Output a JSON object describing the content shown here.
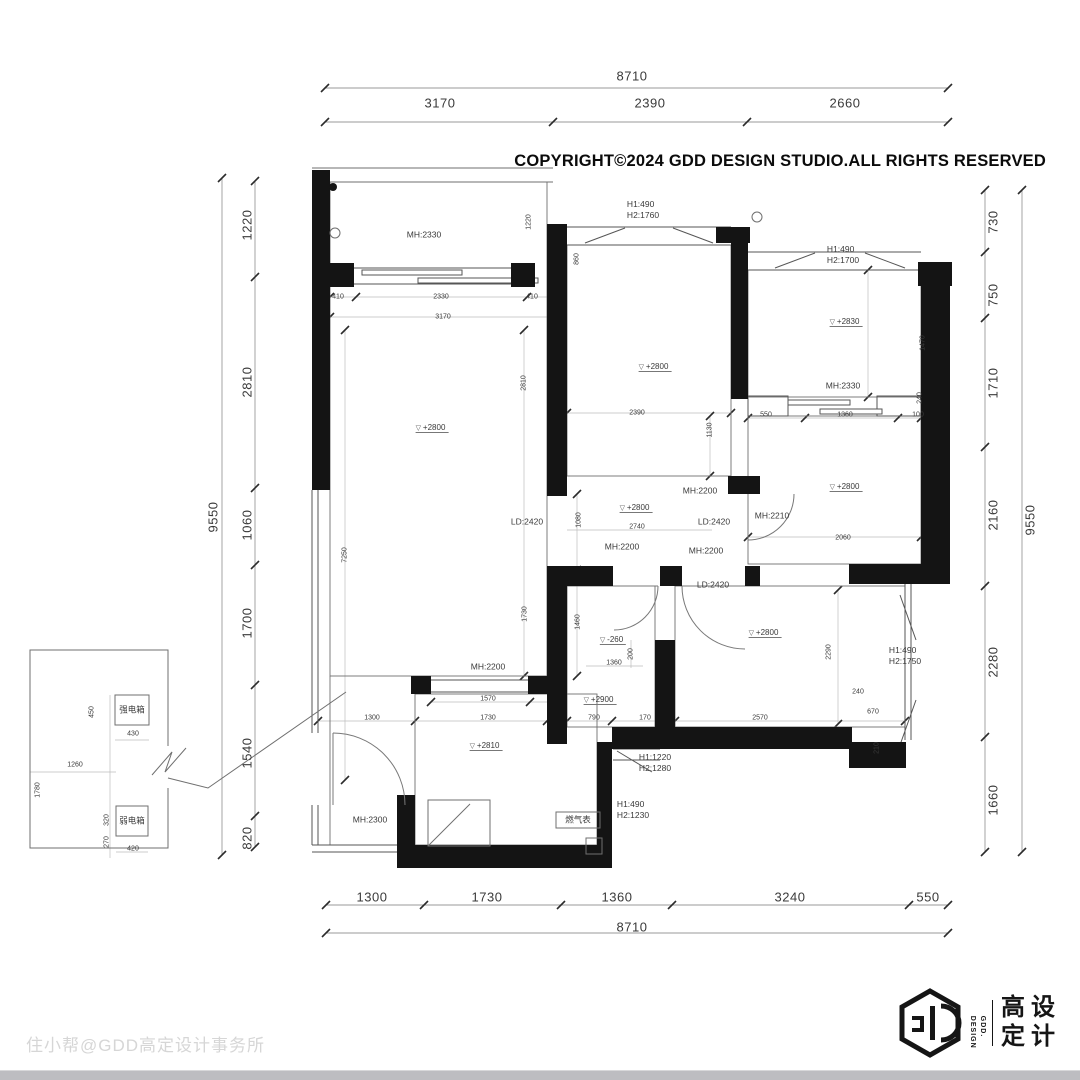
{
  "header": {
    "copyright": "COPYRIGHT©2024 GDD DESIGN STUDIO.ALL RIGHTS RESERVED"
  },
  "footer": {
    "watermark": "住小帮@GDD高定设计事务所"
  },
  "logo": {
    "en_line1": "GDD.",
    "en_line2": "DESIGN",
    "cn_line1": "高设",
    "cn_line2": "定计"
  },
  "plan": {
    "texts": [
      {
        "t": "8710",
        "x": 632,
        "y": 76,
        "k": "outer"
      },
      {
        "t": "3170",
        "x": 440,
        "y": 103,
        "k": "outer"
      },
      {
        "t": "2390",
        "x": 650,
        "y": 103,
        "k": "outer"
      },
      {
        "t": "2660",
        "x": 845,
        "y": 103,
        "k": "outer"
      },
      {
        "t": "1300",
        "x": 372,
        "y": 897,
        "k": "outer"
      },
      {
        "t": "1730",
        "x": 487,
        "y": 897,
        "k": "outer"
      },
      {
        "t": "1360",
        "x": 617,
        "y": 897,
        "k": "outer"
      },
      {
        "t": "3240",
        "x": 790,
        "y": 897,
        "k": "outer"
      },
      {
        "t": "550",
        "x": 928,
        "y": 897,
        "k": "outer"
      },
      {
        "t": "8710",
        "x": 632,
        "y": 927,
        "k": "outer"
      },
      {
        "t": "9550",
        "x": 213,
        "y": 517,
        "k": "outer",
        "r": 1
      },
      {
        "t": "1220",
        "x": 247,
        "y": 225,
        "k": "outer",
        "r": 1
      },
      {
        "t": "2810",
        "x": 247,
        "y": 382,
        "k": "outer",
        "r": 1
      },
      {
        "t": "1060",
        "x": 247,
        "y": 525,
        "k": "outer",
        "r": 1
      },
      {
        "t": "1700",
        "x": 247,
        "y": 623,
        "k": "outer",
        "r": 1
      },
      {
        "t": "1540",
        "x": 247,
        "y": 753,
        "k": "outer",
        "r": 1
      },
      {
        "t": "820",
        "x": 247,
        "y": 838,
        "k": "outer",
        "r": 1
      },
      {
        "t": "9550",
        "x": 1030,
        "y": 520,
        "k": "outer",
        "r": 1
      },
      {
        "t": "730",
        "x": 993,
        "y": 222,
        "k": "outer",
        "r": 1
      },
      {
        "t": "750",
        "x": 993,
        "y": 295,
        "k": "outer",
        "r": 1
      },
      {
        "t": "1710",
        "x": 993,
        "y": 383,
        "k": "outer",
        "r": 1
      },
      {
        "t": "2160",
        "x": 993,
        "y": 515,
        "k": "outer",
        "r": 1
      },
      {
        "t": "2280",
        "x": 993,
        "y": 662,
        "k": "outer",
        "r": 1
      },
      {
        "t": "1660",
        "x": 993,
        "y": 800,
        "k": "outer",
        "r": 1
      },
      {
        "t": "MH:2330",
        "x": 424,
        "y": 235,
        "k": "label"
      },
      {
        "t": "MH:2330",
        "x": 843,
        "y": 386,
        "k": "label"
      },
      {
        "t": "MH:2210",
        "x": 772,
        "y": 516,
        "k": "label"
      },
      {
        "t": "MH:2200",
        "x": 700,
        "y": 491,
        "k": "label"
      },
      {
        "t": "MH:2200",
        "x": 622,
        "y": 547,
        "k": "label"
      },
      {
        "t": "MH:2200",
        "x": 706,
        "y": 551,
        "k": "label"
      },
      {
        "t": "MH:2200",
        "x": 488,
        "y": 667,
        "k": "label"
      },
      {
        "t": "MH:2300",
        "x": 370,
        "y": 820,
        "k": "label"
      },
      {
        "t": "LD:2420",
        "x": 527,
        "y": 522,
        "k": "label"
      },
      {
        "t": "LD:2420",
        "x": 714,
        "y": 522,
        "k": "label"
      },
      {
        "t": "LD:2420",
        "x": 713,
        "y": 585,
        "k": "label"
      },
      {
        "t": "H1:490\nH2:1760",
        "x": 643,
        "y": 210,
        "k": "label"
      },
      {
        "t": "H1:490\nH2:1700",
        "x": 843,
        "y": 255,
        "k": "label"
      },
      {
        "t": "H1:1220\nH2:1280",
        "x": 655,
        "y": 763,
        "k": "label"
      },
      {
        "t": "H1:490\nH2:1230",
        "x": 633,
        "y": 810,
        "k": "label"
      },
      {
        "t": "H1:490\nH2:1750",
        "x": 905,
        "y": 656,
        "k": "label"
      },
      {
        "t": "燃气表",
        "x": 578,
        "y": 820,
        "k": "label"
      },
      {
        "t": "强电箱",
        "x": 132,
        "y": 710,
        "k": "label"
      },
      {
        "t": "弱电箱",
        "x": 132,
        "y": 821,
        "k": "label"
      },
      {
        "t": "+2800",
        "x": 432,
        "y": 428,
        "k": "level"
      },
      {
        "t": "+2800",
        "x": 655,
        "y": 367,
        "k": "level"
      },
      {
        "t": "+2800",
        "x": 846,
        "y": 487,
        "k": "level"
      },
      {
        "t": "+2800",
        "x": 636,
        "y": 508,
        "k": "level"
      },
      {
        "t": "+2800",
        "x": 765,
        "y": 633,
        "k": "level"
      },
      {
        "t": "+2830",
        "x": 846,
        "y": 322,
        "k": "level"
      },
      {
        "t": "+2810",
        "x": 486,
        "y": 746,
        "k": "level"
      },
      {
        "t": "+2900",
        "x": 600,
        "y": 700,
        "k": "level"
      },
      {
        "t": "-260",
        "x": 613,
        "y": 640,
        "k": "level"
      },
      {
        "t": "410",
        "x": 338,
        "y": 297,
        "k": "micro"
      },
      {
        "t": "2330",
        "x": 441,
        "y": 297,
        "k": "micro"
      },
      {
        "t": "410",
        "x": 532,
        "y": 297,
        "k": "micro"
      },
      {
        "t": "3170",
        "x": 443,
        "y": 317,
        "k": "micro"
      },
      {
        "t": "2390",
        "x": 637,
        "y": 413,
        "k": "micro"
      },
      {
        "t": "1130",
        "x": 710,
        "y": 430,
        "k": "micro",
        "r": 1
      },
      {
        "t": "550",
        "x": 766,
        "y": 415,
        "k": "micro"
      },
      {
        "t": "1360",
        "x": 845,
        "y": 415,
        "k": "micro"
      },
      {
        "t": "100",
        "x": 918,
        "y": 415,
        "k": "micro"
      },
      {
        "t": "1470",
        "x": 923,
        "y": 343,
        "k": "micro",
        "r": 1
      },
      {
        "t": "240",
        "x": 920,
        "y": 398,
        "k": "micro",
        "r": 1
      },
      {
        "t": "2740",
        "x": 637,
        "y": 527,
        "k": "micro"
      },
      {
        "t": "2060",
        "x": 843,
        "y": 538,
        "k": "micro"
      },
      {
        "t": "1080",
        "x": 579,
        "y": 520,
        "k": "micro",
        "r": 1
      },
      {
        "t": "1730",
        "x": 525,
        "y": 614,
        "k": "micro",
        "r": 1
      },
      {
        "t": "1460",
        "x": 578,
        "y": 622,
        "k": "micro",
        "r": 1
      },
      {
        "t": "1360",
        "x": 614,
        "y": 663,
        "k": "micro"
      },
      {
        "t": "200",
        "x": 631,
        "y": 654,
        "k": "micro",
        "r": 1
      },
      {
        "t": "790",
        "x": 594,
        "y": 718,
        "k": "micro"
      },
      {
        "t": "170",
        "x": 645,
        "y": 718,
        "k": "micro"
      },
      {
        "t": "2570",
        "x": 760,
        "y": 718,
        "k": "micro"
      },
      {
        "t": "2290",
        "x": 829,
        "y": 652,
        "k": "micro",
        "r": 1
      },
      {
        "t": "240",
        "x": 858,
        "y": 692,
        "k": "micro"
      },
      {
        "t": "670",
        "x": 873,
        "y": 712,
        "k": "micro"
      },
      {
        "t": "210",
        "x": 877,
        "y": 748,
        "k": "micro",
        "r": 1
      },
      {
        "t": "1570",
        "x": 488,
        "y": 699,
        "k": "micro"
      },
      {
        "t": "1730",
        "x": 488,
        "y": 718,
        "k": "micro"
      },
      {
        "t": "1300",
        "x": 372,
        "y": 718,
        "k": "micro"
      },
      {
        "t": "2810",
        "x": 524,
        "y": 383,
        "k": "micro",
        "r": 1
      },
      {
        "t": "7250",
        "x": 345,
        "y": 555,
        "k": "micro",
        "r": 1
      },
      {
        "t": "1220",
        "x": 529,
        "y": 222,
        "k": "micro",
        "r": 1
      },
      {
        "t": "860",
        "x": 577,
        "y": 259,
        "k": "micro",
        "r": 1
      },
      {
        "t": "430",
        "x": 133,
        "y": 734,
        "k": "micro"
      },
      {
        "t": "450",
        "x": 92,
        "y": 712,
        "k": "micro",
        "r": 1
      },
      {
        "t": "420",
        "x": 133,
        "y": 849,
        "k": "micro"
      },
      {
        "t": "320",
        "x": 107,
        "y": 820,
        "k": "micro",
        "r": 1
      },
      {
        "t": "270",
        "x": 107,
        "y": 842,
        "k": "micro",
        "r": 1
      },
      {
        "t": "1260",
        "x": 75,
        "y": 765,
        "k": "micro"
      },
      {
        "t": "1780",
        "x": 38,
        "y": 790,
        "k": "micro",
        "r": 1
      }
    ]
  }
}
